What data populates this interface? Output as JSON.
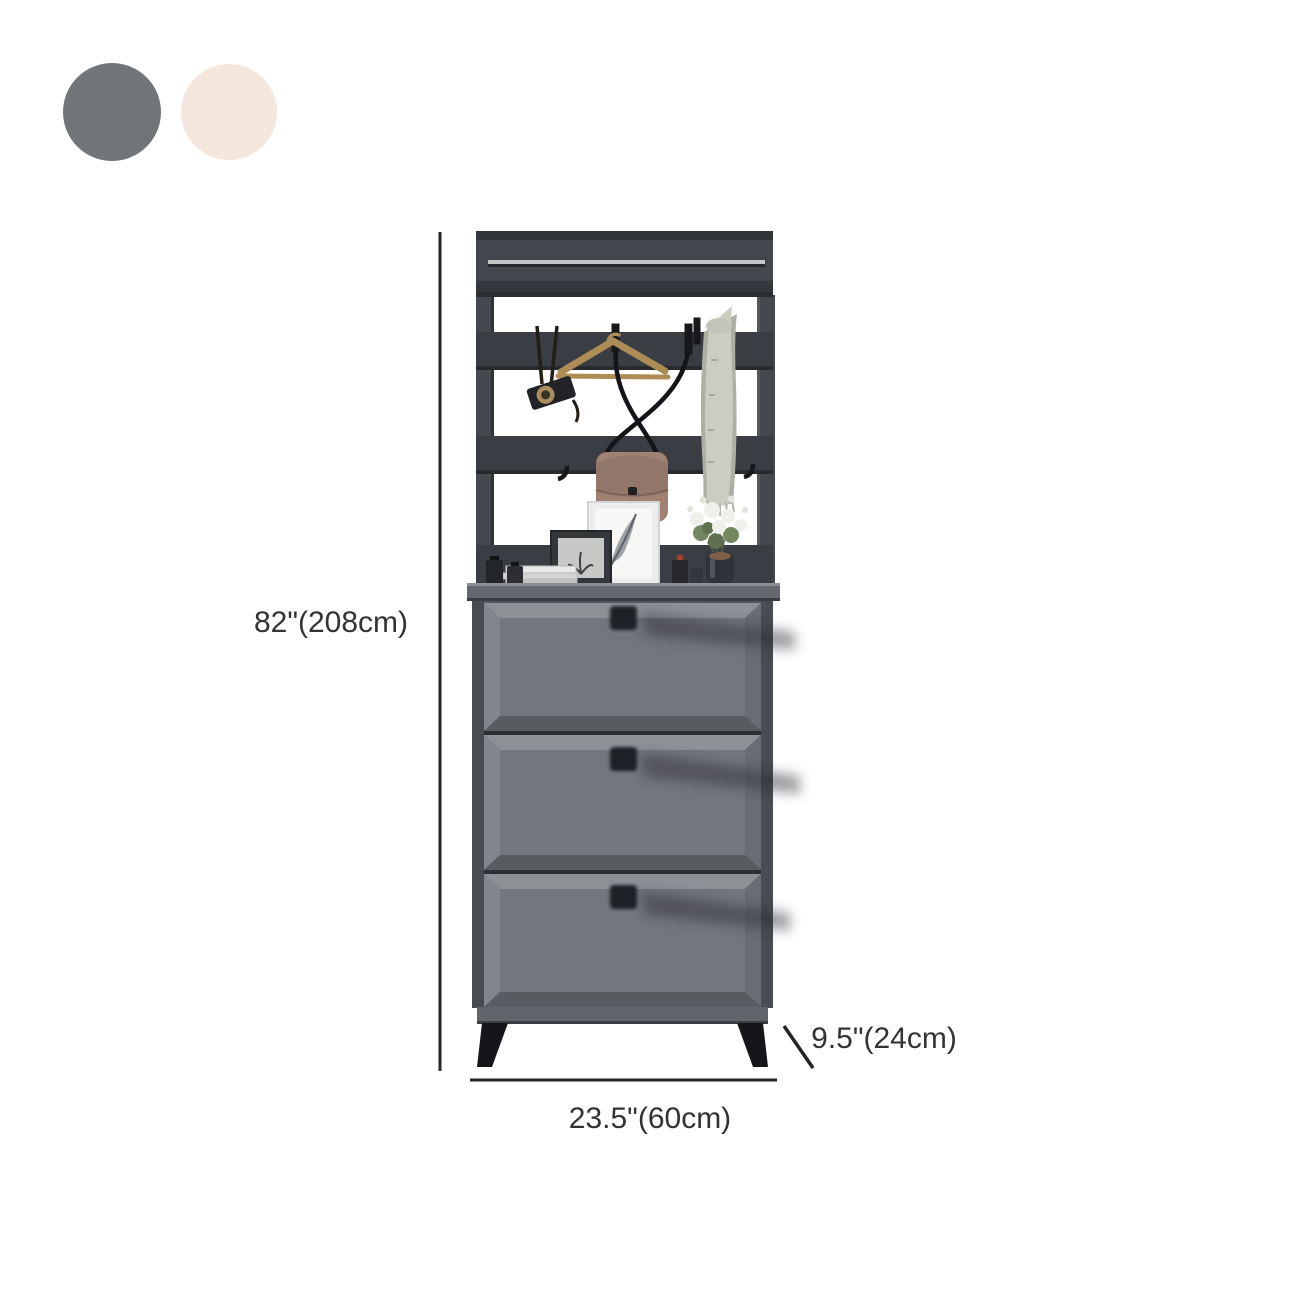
{
  "swatches": {
    "gray": {
      "label": "dark gray swatch",
      "color": "#717479"
    },
    "cream": {
      "label": "cream swatch",
      "color": "#f3e6dd"
    }
  },
  "dimensions": {
    "height": "82\"(208cm)",
    "width": "23.5\"(60cm)",
    "depth": "9.5\"(24cm)"
  },
  "colors": {
    "frame_dark": "#3a3d43",
    "frame_face": "#43464c",
    "frame_top": "#323539",
    "rail_metal": "#c3c5c7",
    "counter": "#65686e",
    "counter_hilite": "#8b8f94",
    "body": "#54585e",
    "drawer_frame": "#515459",
    "drawer_panel": "#73767c",
    "bevel_top": "#8d9196",
    "bevel_left": "#82868c",
    "bevel_right": "#696d72",
    "bevel_bottom": "#585b60",
    "divider": "#2c2e32",
    "knob": "#1f2226",
    "leg": "#141619",
    "base": "#61646a",
    "bag": "#a08172",
    "bag_flap": "#94776b",
    "scarf_front": "#ccccc3",
    "scarf_back": "#aeae a3",
    "hanger_wood": "#ad8c55",
    "strap_black": "#17181b",
    "flower_white": "#eef0e9",
    "leaf_green": "#75875f",
    "dimension_line": "#242424",
    "label_text": "#333333"
  }
}
